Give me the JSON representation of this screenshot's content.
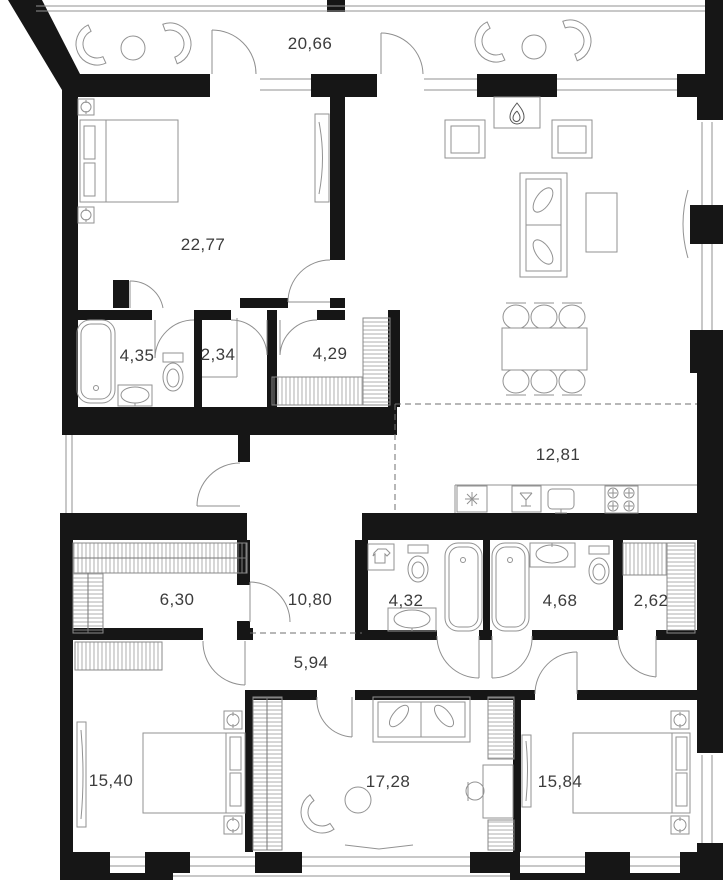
{
  "plan": {
    "type": "apartment-floor-plan",
    "colors": {
      "background": "#ffffff",
      "walls": "#161616",
      "lines": "#929292",
      "labels": "#3c3c3c"
    },
    "rooms": [
      {
        "id": "terrace",
        "area": "20,66"
      },
      {
        "id": "bedroom-1",
        "area": "22,77"
      },
      {
        "id": "bathroom-1",
        "area": "4,35"
      },
      {
        "id": "wc",
        "area": "2,34"
      },
      {
        "id": "hall-closet",
        "area": "4,29"
      },
      {
        "id": "kitchen-zone",
        "area": "12,81"
      },
      {
        "id": "walk-in-closet",
        "area": "6,30"
      },
      {
        "id": "hall",
        "area": "10,80"
      },
      {
        "id": "bathroom-2",
        "area": "4,32"
      },
      {
        "id": "bathroom-3",
        "area": "4,68"
      },
      {
        "id": "closet",
        "area": "2,62"
      },
      {
        "id": "corridor",
        "area": "5,94"
      },
      {
        "id": "bedroom-2",
        "area": "15,40"
      },
      {
        "id": "study-lounge",
        "area": "17,28"
      },
      {
        "id": "bedroom-3",
        "area": "15,84"
      }
    ],
    "icons": {
      "fireplace": "flame",
      "refrigerator": "snowflake-asterisk",
      "kitchen-sink": "basin-with-tap",
      "hob": "four-burners",
      "washing-machine": "shirt",
      "wardrobe": "coil-hatch",
      "nightstand": "lamp-dot"
    }
  }
}
